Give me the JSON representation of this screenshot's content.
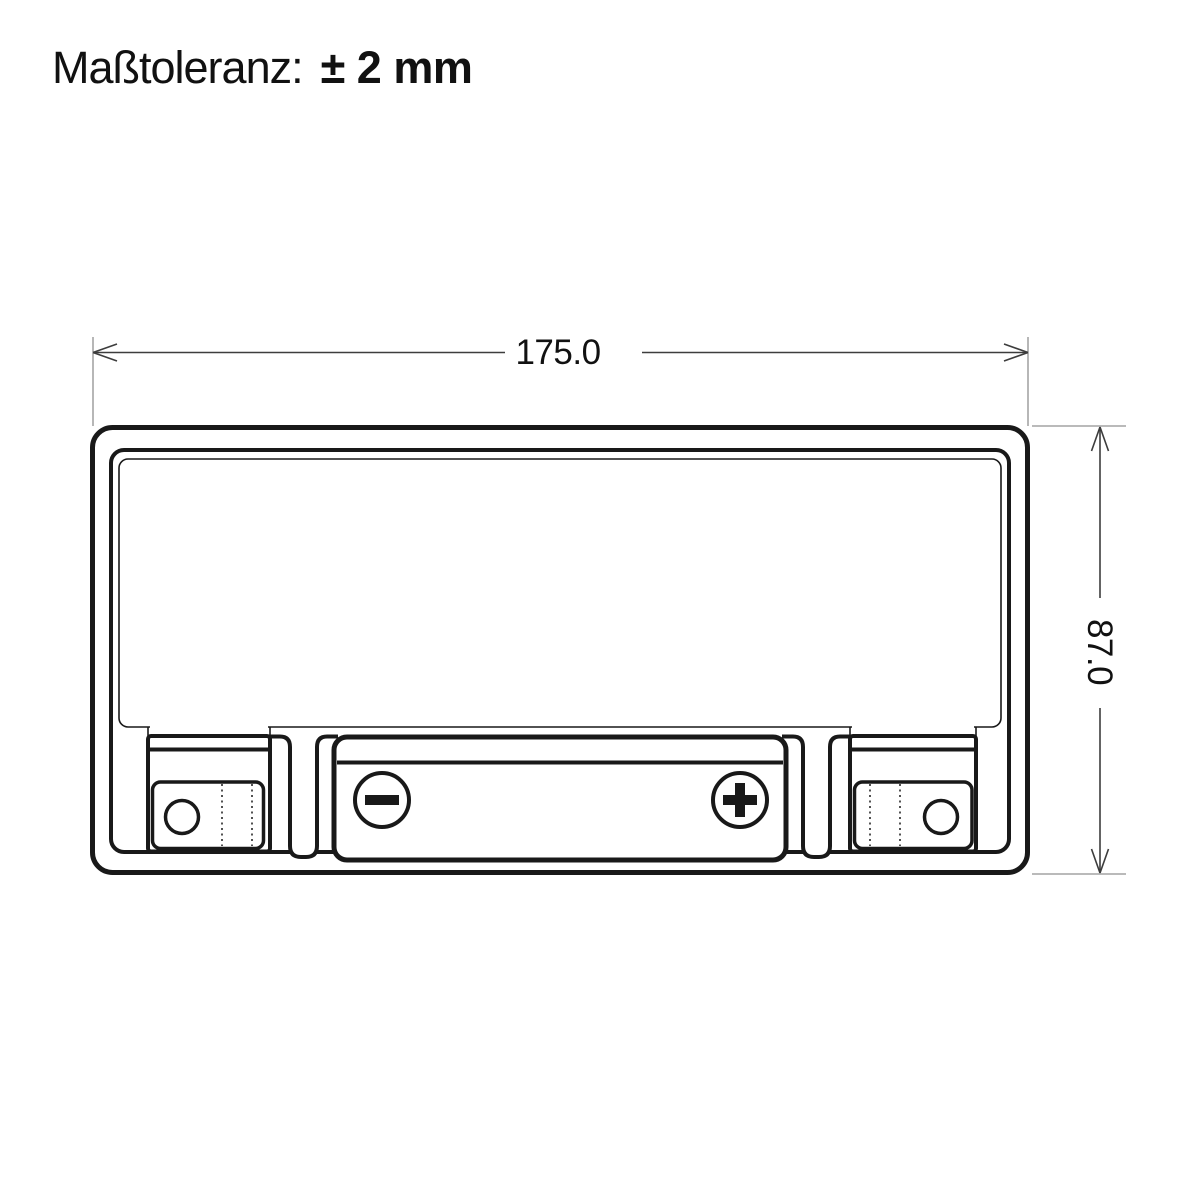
{
  "header": {
    "tolerance_label": "Maßtoleranz:",
    "tolerance_value": "± 2 mm"
  },
  "drawing": {
    "width_dimension": "175.0",
    "height_dimension": "87.0",
    "terminals": {
      "negative_symbol": "−",
      "positive_symbol": "+"
    }
  },
  "colors": {
    "line": "#191919",
    "dim_line": "#3d3d3d",
    "ext_line": "#909090",
    "text": "#111111",
    "background": "#ffffff"
  }
}
